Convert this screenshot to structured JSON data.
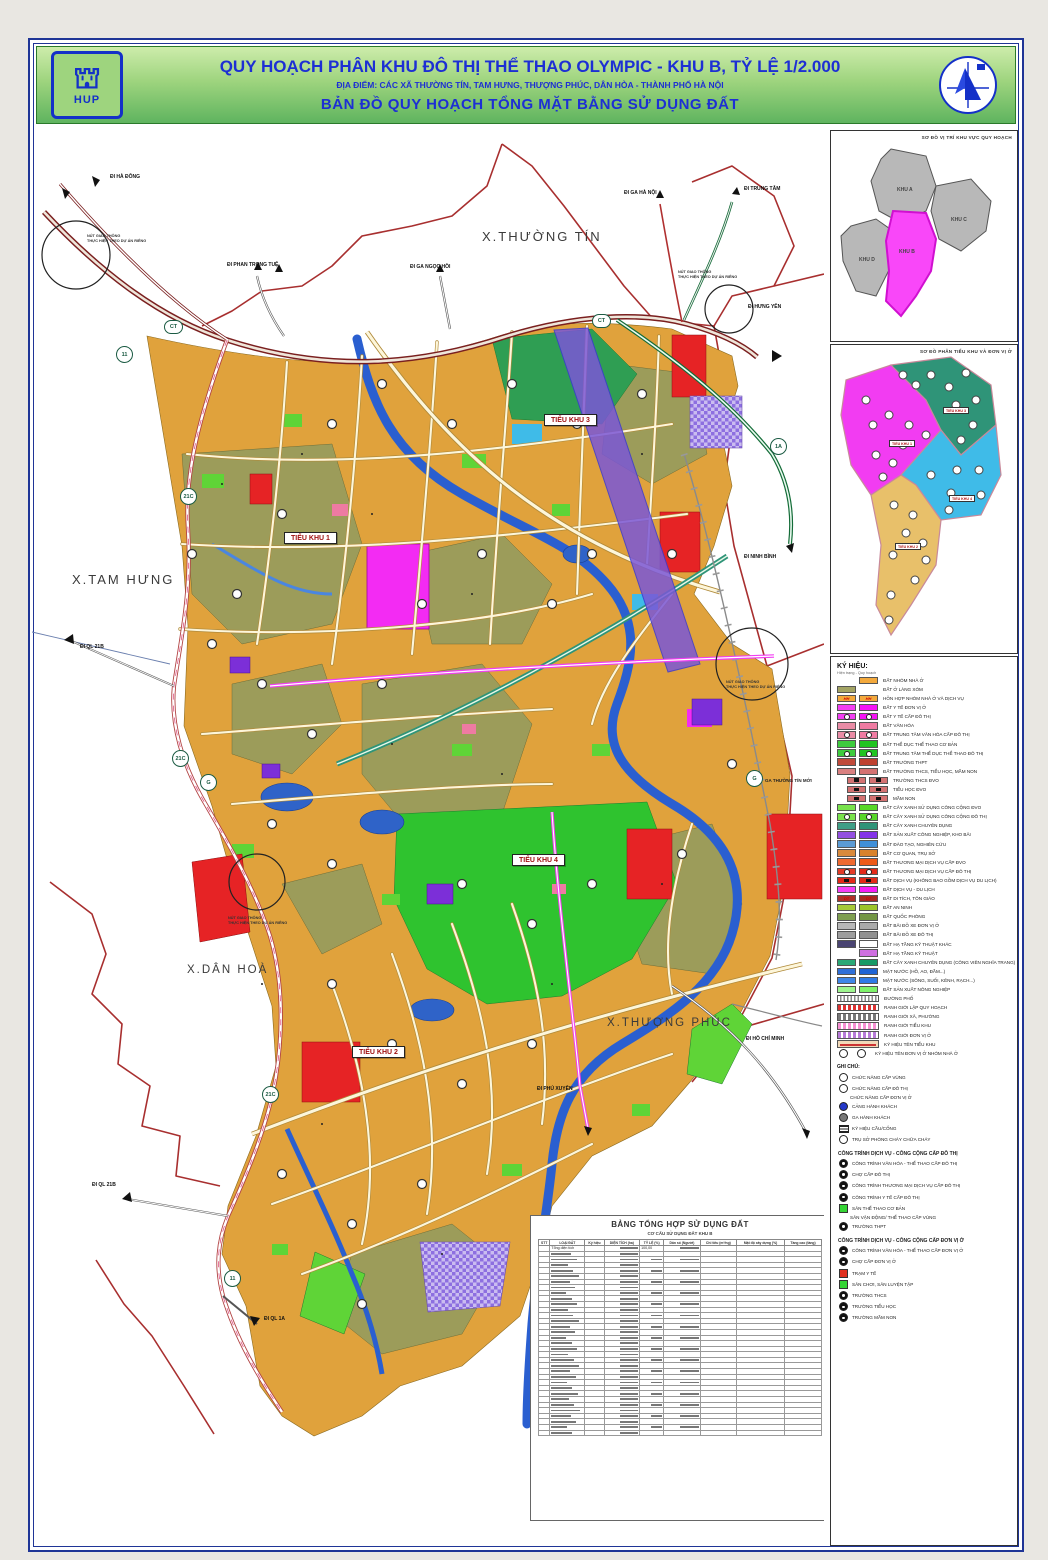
{
  "header": {
    "title": "QUY HOẠCH PHÂN KHU ĐÔ THỊ THỂ THAO OLYMPIC - KHU B, TỶ LỆ 1/2.000",
    "subtitle": "ĐỊA ĐIỂM: CÁC XÃ THƯỜNG TÍN, TAM HƯNG, THƯỢNG PHÚC, DÂN HÒA - THÀNH PHỐ HÀ NỘI",
    "map_title": "BẢN ĐỒ QUY HOẠCH TỔNG MẶT BẰNG SỬ DỤNG ĐẤT",
    "logo_left": "HUP"
  },
  "map": {
    "areas": [
      "X.THƯỜNG TÍN",
      "X.TAM HƯNG",
      "X.DÂN HOÀ",
      "X.THƯỢNG PHÚC"
    ],
    "subzones": [
      "TIỂU KHU 1",
      "TIỂU KHU 2",
      "TIỂU KHU 3",
      "TIỂU KHU 4"
    ],
    "badges": {
      "ct": "CT",
      "r11": "11",
      "r21c": "21C",
      "r1a": "1A",
      "g": "G"
    },
    "directions": [
      "ĐI HÀ ĐÔNG",
      "ĐI PHAN TRỌNG TUỆ",
      "ĐI GA HÀ NỘI",
      "ĐI TRUNG TÂM",
      "ĐI GA NGỌC HỒI",
      "ĐI HƯNG YÊN",
      "ĐI NINH BÌNH",
      "ĐI QL 21B",
      "ĐI QL 21B",
      "ĐI QL 1A",
      "ĐI PHÚ XUYÊN",
      "ĐI HỒ CHÍ MINH"
    ],
    "station": "GA THƯỜNG TÍN MỚI",
    "junction_note_1": "NÚT GIAO THÔNG",
    "junction_note_2": "THỰC HIỆN THEO DỰ ÁN RIÊNG"
  },
  "insets": {
    "location": {
      "title": "SƠ ĐỒ VỊ TRÍ KHU VỰC QUY HOẠCH",
      "regions": [
        "KHU A",
        "KHU B",
        "KHU C",
        "KHU D"
      ],
      "highlight_color": "#f947f9"
    },
    "subzone_map": {
      "title": "SƠ ĐỒ PHÂN TIỂU KHU VÀ ĐƠN VỊ Ở",
      "zone_colors": {
        "tieu_khu_1": "#f23cf2",
        "tieu_khu_2": "#e8c06a",
        "tieu_khu_3": "#2f9478",
        "tieu_khu_4": "#3fbbe8"
      }
    }
  },
  "legend": {
    "title": "KÝ HIỆU:",
    "columns_note": "Hiện trạng - Quy hoạch",
    "items": [
      {
        "label": "ĐẤT NHÓM NHÀ Ở",
        "a": null,
        "b": "#f3a93c"
      },
      {
        "label": "ĐẤT Ở LÀNG XÓM",
        "a": "#a3a464",
        "b": null
      },
      {
        "label": "HỖN HỢP NHÓM NHÀ Ở VÀ DỊCH VỤ",
        "a": "#f3a93c",
        "b": "#f3a93c",
        "sym": "st",
        "sym_text": "HH"
      },
      {
        "label": "ĐẤT Y TẾ ĐƠN VỊ Ở",
        "a": "#f23ff2",
        "b": "#f513f5"
      },
      {
        "label": "ĐẤT Y TẾ CẤP ĐÔ THỊ",
        "a": "#f23ff2",
        "b": "#f513f5",
        "sym": "dot"
      },
      {
        "label": "ĐẤT VĂN HÓA",
        "a": "#e98ca6",
        "b": "#ef7ba2"
      },
      {
        "label": "ĐẤT TRUNG TÂM VĂN HÓA CẤP ĐÔ THỊ",
        "a": "#e98ca6",
        "b": "#ef7ba2",
        "sym": "dot"
      },
      {
        "label": "ĐẤT THỂ DỤC THỂ THAO CƠ BẢN",
        "a": "#3ecb3e",
        "b": "#21c421"
      },
      {
        "label": "ĐẤT TRUNG TÂM THỂ DỤC THỂ THAO ĐÔ THỊ",
        "a": "#3ecb3e",
        "b": "#21c421",
        "sym": "dot"
      },
      {
        "label": "ĐẤT TRƯỜNG THPT",
        "a": "#c04a3a",
        "b": "#bf4130"
      },
      {
        "label": "ĐẤT TRƯỜNG THCS, TIỂU HỌC, MẦM NON",
        "a": "#d98080",
        "b": "#d47272"
      },
      {
        "label": "TRƯỜNG THCS ĐVO",
        "a": "#d47272",
        "b": "#d47272",
        "sym": "sq",
        "indent": true
      },
      {
        "label": "TIỂU HỌC ĐVO",
        "a": "#d47272",
        "b": "#d47272",
        "sym": "sq",
        "indent": true
      },
      {
        "label": "MẦM NON",
        "a": "#d47272",
        "b": "#d47272",
        "sym": "sq",
        "indent": true
      },
      {
        "label": "ĐẤT CÂY XANH SỬ DỤNG CÔNG CỘNG ĐVO",
        "a": "#79e24c",
        "b": "#57d728"
      },
      {
        "label": "ĐẤT CÂY XANH SỬ DỤNG CÔNG CỘNG ĐÔ THỊ",
        "a": "#79e24c",
        "b": "#57d728",
        "sym": "dot"
      },
      {
        "label": "ĐẤT CÂY XANH CHUYÊN DỤNG",
        "a": "#3f9e86",
        "b": "#2f9478"
      },
      {
        "label": "ĐẤT SẢN XUẤT CÔNG NGHIỆP, KHO BÃI",
        "a": "#9350e0",
        "b": "#8433e8"
      },
      {
        "label": "ĐẤT ĐÀO TẠO, NGHIÊN CỨU",
        "a": "#5b9bd5",
        "b": "#3f8fd8"
      },
      {
        "label": "ĐẤT CƠ QUAN, TRỤ SỞ",
        "a": "#d98a3c",
        "b": "#d8822c"
      },
      {
        "label": "ĐẤT THƯƠNG MẠI DỊCH VỤ CẤP ĐVO",
        "a": "#ef6a30",
        "b": "#ee5a18"
      },
      {
        "label": "ĐẤT THƯƠNG MẠI DỊCH VỤ CẤP ĐÔ THỊ",
        "a": "#e33c28",
        "b": "#e32918",
        "sym": "dot"
      },
      {
        "label": "ĐẤT DỊCH VỤ (KHÔNG BAO GỒM DỊCH VỤ DU LỊCH)",
        "a": "#e32918",
        "b": "#e32918",
        "sym": "sq"
      },
      {
        "label": "ĐẤT DỊCH VỤ - DU LỊCH",
        "a": "#f53ff5",
        "b": "#f51df5"
      },
      {
        "label": "ĐẤT DI TÍCH, TÔN GIÁO",
        "a": "#b03028",
        "b": "#a82820",
        "sym": "st",
        "sym_text": "DT"
      },
      {
        "label": "ĐẤT AN NINH",
        "a": "#a6c938",
        "b": "#9cc428"
      },
      {
        "label": "ĐẤT QUỐC PHÒNG",
        "a": "#7e9e50",
        "b": "#739644"
      },
      {
        "label": "ĐẤT BÃI ĐỖ XE ĐƠN VỊ Ở",
        "a": "#b8b8b8",
        "b": "#aaaaaa"
      },
      {
        "label": "ĐẤT BÃI ĐỖ XE ĐÔ THỊ",
        "a": "#9d9d9d",
        "b": "#909090"
      },
      {
        "label": "ĐẤT HẠ TẦNG KỸ THUẬT KHÁC",
        "a": "#4a4472",
        "b": "#ffffff"
      },
      {
        "label": "ĐẤT HẠ TẦNG KỸ THUẬT",
        "a": null,
        "b": "#cf6fe0"
      },
      {
        "label": "ĐẤT CÂY XANH CHUYÊN DỤNG (CÔNG VIÊN NGHĨA TRANG)",
        "a": "#2aa876",
        "b": "#189a66"
      },
      {
        "label": "MẶT NƯỚC (HỒ, AO, ĐẦM...)",
        "a": "#2f6fd8",
        "b": "#1f63d4"
      },
      {
        "label": "MẶT NƯỚC (SÔNG, SUỐI, KÊNH, RẠCH...)",
        "a": "#3f86e8",
        "b": "#2f7ae6"
      },
      {
        "label": "ĐẤT SẢN XUẤT NÔNG NGHIỆP",
        "a": "#9ef58f",
        "b": "#7ef26a"
      },
      {
        "label": "ĐƯỜNG PHỐ",
        "type": "line",
        "style": "lnroad"
      },
      {
        "label": "RANH GIỚI LẬP QUY HOẠCH",
        "type": "line",
        "style": "lnred"
      },
      {
        "label": "RANH GIỚI XÃ, PHƯỜNG",
        "type": "line",
        "style": "lngray"
      },
      {
        "label": "RANH GIỚI TIỂU KHU",
        "type": "line",
        "style": "lnpink"
      },
      {
        "label": "RANH GIỚI ĐƠN VỊ Ở",
        "type": "line",
        "style": "lnviolet"
      },
      {
        "label": "KÝ HIỆU TÊN TIỂU KHU",
        "type": "line",
        "style": "lntag"
      },
      {
        "label": "KÝ HIỆU TÊN ĐƠN VỊ Ở NHÓM NHÀ Ở",
        "type": "circles"
      }
    ],
    "notes_title": "GHI CHÚ:",
    "notes": [
      {
        "sym": "ring",
        "label": "CHỨC NĂNG CẤP VÙNG"
      },
      {
        "sym": "ring",
        "label": "CHỨC NĂNG CẤP ĐÔ THỊ"
      },
      {
        "sym": "none",
        "label": "CHỨC NĂNG CẤP ĐƠN VỊ Ở"
      },
      {
        "sym": "blue",
        "label": "CẢNG HÀNH KHÁCH"
      },
      {
        "sym": "gray",
        "label": "GA HÀNH KHÁCH"
      },
      {
        "sym": "bridge",
        "label": "KÝ HIỆU CẦU/CỐNG"
      },
      {
        "sym": "fire",
        "label": "TRỤ SỞ PHÒNG CHÁY CHỮA CHÁY"
      }
    ],
    "groups": [
      {
        "title": "CÔNG TRÌNH DỊCH VỤ - CÔNG CỘNG CẤP ĐÔ THỊ",
        "items": [
          {
            "sym": "fillc",
            "label": "CÔNG TRÌNH VĂN HÓA - THỂ THAO CẤP ĐÔ THỊ"
          },
          {
            "sym": "fillc",
            "label": "CHỢ CẤP ĐÔ THỊ"
          },
          {
            "sym": "fillc",
            "label": "CÔNG TRÌNH THƯƠNG MẠI DỊCH VỤ CẤP ĐÔ THỊ"
          },
          {
            "sym": "fillc",
            "label": "CÔNG TRÌNH Y TẾ CẤP ĐÔ THỊ"
          },
          {
            "sym": "sq-green",
            "label": "SÂN THỂ THAO CƠ BẢN"
          },
          {
            "sym": "none",
            "label": "SÂN VẬN ĐỘNG/ THỂ THAO CẤP VÙNG"
          },
          {
            "sym": "fillc",
            "label": "TRƯỜNG THPT"
          }
        ]
      },
      {
        "title": "CÔNG TRÌNH DỊCH VỤ - CÔNG CỘNG CẤP ĐƠN VỊ Ở",
        "items": [
          {
            "sym": "fillc",
            "label": "CÔNG TRÌNH VĂN HÓA - THỂ THAO CẤP ĐƠN VỊ Ở"
          },
          {
            "sym": "fillc",
            "label": "CHỢ CẤP ĐƠN VỊ Ở"
          },
          {
            "sym": "sq-red",
            "label": "TRẠM Y TẾ"
          },
          {
            "sym": "sq-green",
            "label": "SÂN CHƠI, SÂN LUYỆN TẬP"
          },
          {
            "sym": "fillc",
            "label": "TRƯỜNG THCS"
          },
          {
            "sym": "fillc",
            "label": "TRƯỜNG TIỂU HỌC"
          },
          {
            "sym": "fillc",
            "label": "TRƯỜNG MẦM NON"
          }
        ]
      }
    ]
  },
  "table": {
    "title": "BẢNG TỔNG HỢP SỬ DỤNG ĐẤT",
    "subtitle": "CƠ CẤU SỬ DỤNG ĐẤT KHU B",
    "headers": [
      "STT",
      "LOẠI ĐẤT",
      "Ký hiệu",
      "DIỆN TÍCH (ha)",
      "TỶ LỆ (%)",
      "Dân số (Người)",
      "Chỉ tiêu (m²/ng)",
      "Mật độ xây dựng (%)",
      "Tầng cao (tầng)"
    ],
    "first_row_label": "Tổng diện tích",
    "first_row_ratio": "100,00"
  }
}
